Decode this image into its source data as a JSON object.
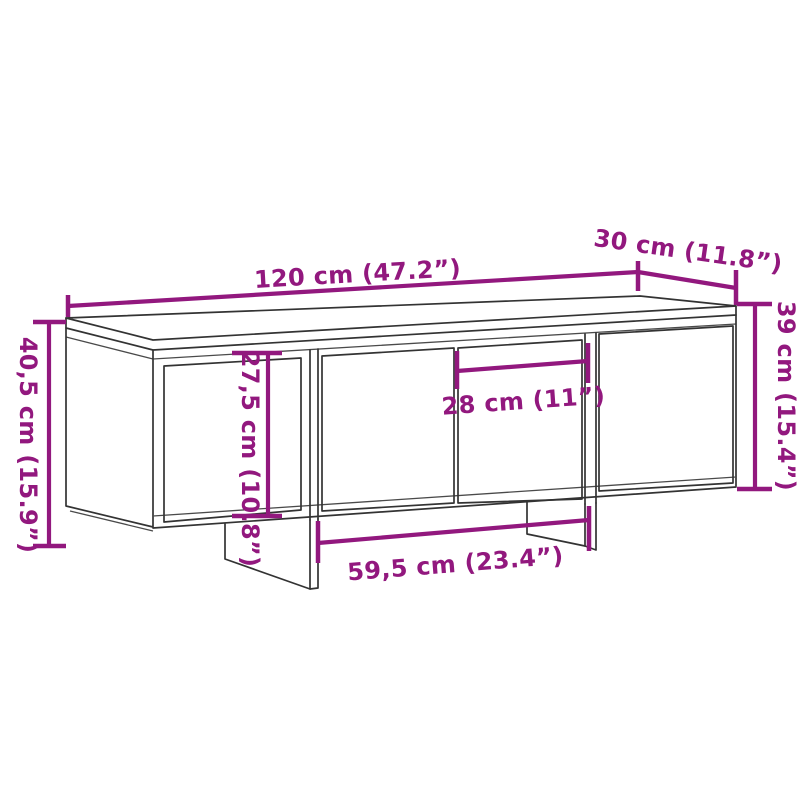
{
  "diagram": {
    "type": "furniture-dimension-drawing",
    "dimension_labels": {
      "overall_width": "120 cm (47.2”)",
      "depth": "30 cm (11.8”)",
      "overall_height": "40,5 cm (15.9”)",
      "carcass_height": "39 cm (15.4”)",
      "inner_height": "27,5 cm (10.8”)",
      "door_width": "28 cm (11”)",
      "inner_width": "59,5 cm (23.4”)"
    },
    "colors": {
      "dimension_accent": "#92187E",
      "line_art": "#333333",
      "background": "#FFFFFF"
    }
  }
}
